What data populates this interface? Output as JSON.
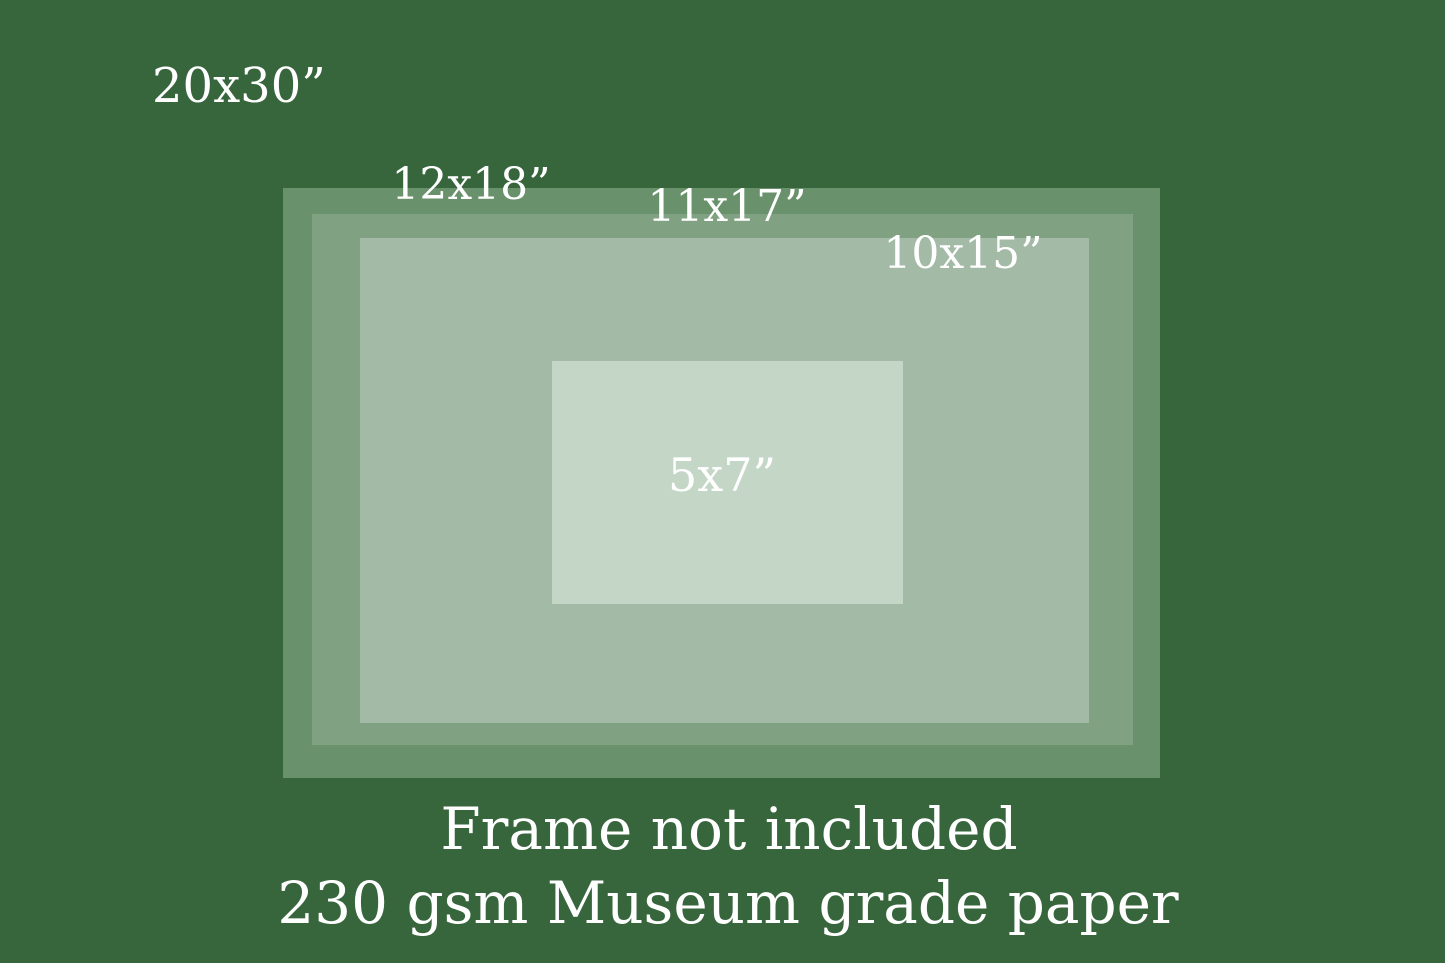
{
  "palette": {
    "background": "#37663D",
    "text": "#FFFFFF",
    "rect_12x18": "#68916C",
    "rect_11x17": "#80A283",
    "rect_10x15": "#A3BAA6",
    "rect_5x7": "#C4D6C6"
  },
  "size_labels": {
    "s20x30": "20x30”",
    "s12x18": "12x18”",
    "s11x17": "11x17”",
    "s10x15": "10x15”",
    "s5x7": "5x7”"
  },
  "footer": {
    "line1": "Frame not included",
    "line2": "230 gsm Museum grade paper"
  }
}
